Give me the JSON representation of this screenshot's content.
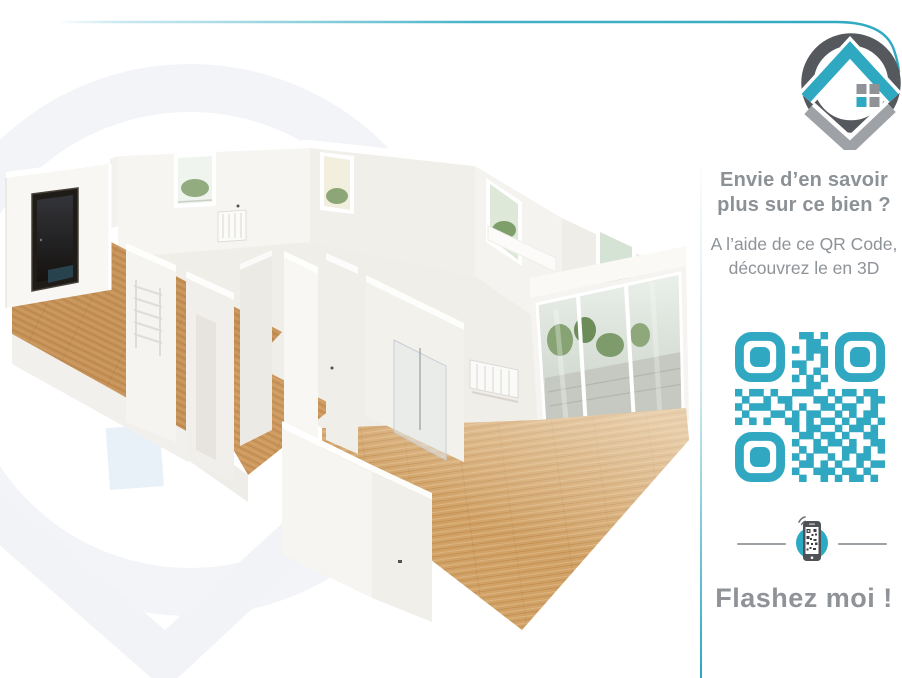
{
  "branding": {
    "logo_icon": "house-location-pin-logo",
    "colors": {
      "teal": "#2FA9C2",
      "ring_dark_gray": "#55585D",
      "pin_gray": "#9EA2A6",
      "window_gray": "#8F9398"
    }
  },
  "accent": {
    "top_line_color": "#35AAC3",
    "divider_bottom_color": "#2AA9C0"
  },
  "sidebar": {
    "headline_lines": [
      "Envie d’en savoir",
      "plus sur ce bien ?"
    ],
    "subheadline_lines": [
      "A l’aide de ce QR Code,",
      "découvrez le en 3D"
    ],
    "text_color": "#8C9196",
    "qr": {
      "color": "#31A8C2",
      "matrix": [
        "000000000110100000000",
        "000000000011000000000",
        "000000001011100000000",
        "000000000010100000000",
        "000000001100100000000",
        "000000000101000000000",
        "000000001010100000000",
        "000000000011000000000",
        "101101001110010110110",
        "010010110001101001011",
        "101110010100110110010",
        "010001101011001010110",
        "101010011010110101101",
        "000000001011001011010",
        "000000000110110100110",
        "000000001001011010011",
        "000000000101100110101",
        "000000001010010101100",
        "000000000110101001011",
        "000000001001110110100",
        "000000000100101011010"
      ]
    },
    "phone_icon": "smartphone-qr-scan-icon",
    "cta_text": "Flashez moi !",
    "cta_color": "#8F9398"
  },
  "main": {
    "illustration": "3d-dollhouse-apartment-floorplan",
    "watermark_icon": "house-pin-watermark",
    "watermark_color": "#F1F3F6",
    "palette": {
      "wood": "#CC985D",
      "wood_light": "#D1A165",
      "wall_white": "#F7F5F2",
      "wall_shade": "#EFEDE8",
      "entry_door_dark": "#1F1B17",
      "glass_green": "#7E9E6A",
      "terrace_gray": "#C5C9C2"
    }
  }
}
